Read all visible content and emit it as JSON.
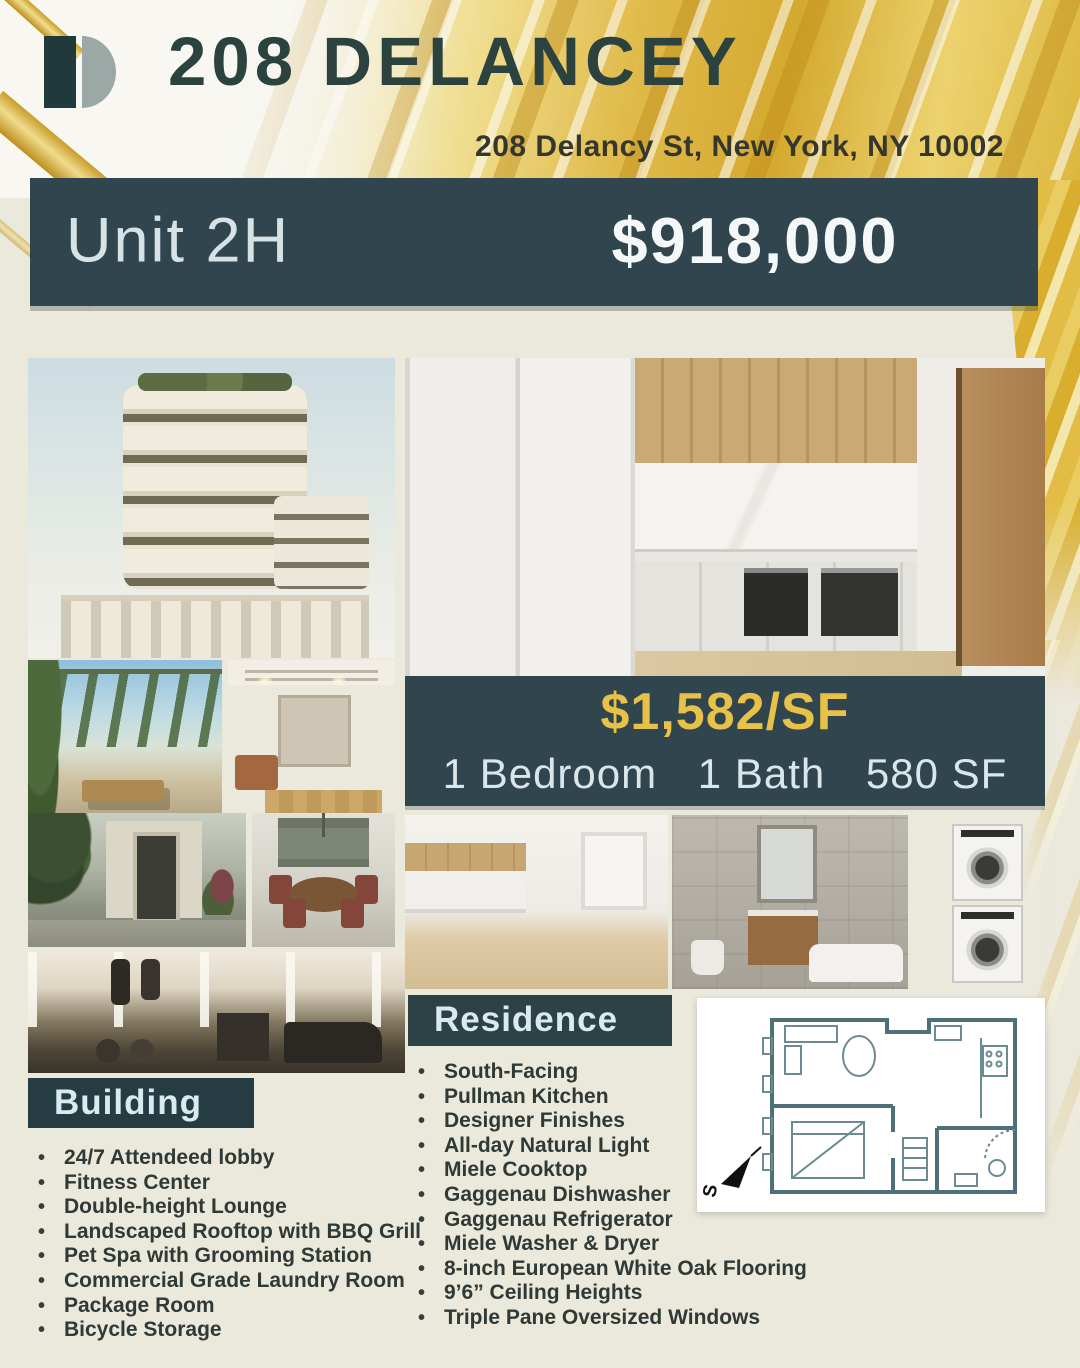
{
  "header": {
    "title": "208 DELANCEY",
    "address": "208 Delancy St, New York, NY 10002"
  },
  "listing": {
    "unit": "Unit 2H",
    "price": "$918,000",
    "price_per_sf": "$1,582/SF",
    "bedrooms": "1 Bedroom",
    "baths": "1 Bath",
    "area": "580 SF"
  },
  "sections": {
    "building": {
      "title": "Building",
      "items": [
        "24/7 Attendeed lobby",
        "Fitness Center",
        "Double-height Lounge",
        "Landscaped Rooftop with BBQ Grill",
        "Pet Spa with Grooming Station",
        "Commercial Grade Laundry Room",
        "Package Room",
        "Bicycle Storage"
      ]
    },
    "residence": {
      "title": "Residence",
      "items": [
        "South-Facing",
        "Pullman Kitchen",
        "Designer Finishes",
        "All-day Natural Light",
        "Miele Cooktop",
        "Gaggenau Dishwasher",
        "Gaggenau Refrigerator",
        "Miele Washer & Dryer",
        "8-inch European White Oak Flooring",
        "9’6” Ceiling Heights",
        "Triple Pane Oversized Windows"
      ]
    }
  },
  "floor_plan": {
    "compass_label": "S"
  },
  "colors": {
    "teal": "#30454d",
    "teal_dark": "#263c43",
    "gold_text": "#e7c148",
    "title_text": "#2c423f",
    "background": "#ebe8dc"
  }
}
